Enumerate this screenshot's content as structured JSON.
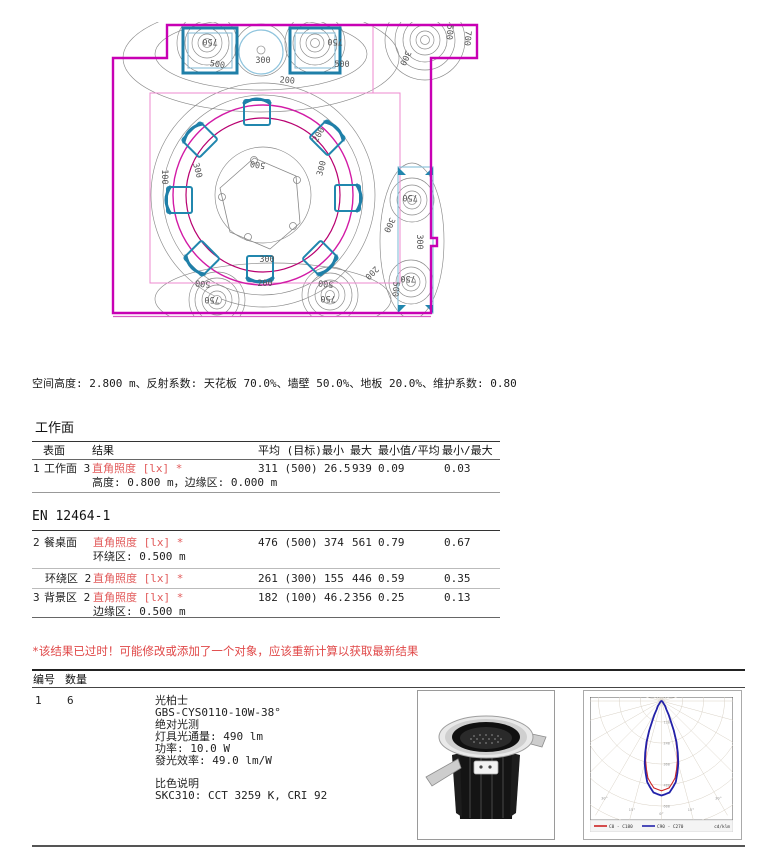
{
  "summary": "空间高度: 2.800 m、反射系数: 天花板 70.0%、墙壁 50.0%、地板 20.0%、维护系数: 0.80",
  "worksurface": {
    "title": "工作面",
    "headers": {
      "surface": "表面",
      "result": "结果",
      "avg": "平均 (目标)",
      "min": "最小",
      "max": "最大",
      "min_avg": "最小值/平均",
      "min_max": "最小/最大"
    },
    "row": {
      "num": "1",
      "surface": "工作面 3",
      "result": "直角照度 [lx] *",
      "sub": "高度: 0.800 m，边缘区: 0.000 m",
      "avg": "311 (500)",
      "min": "26.5",
      "max": "939",
      "min_avg": "0.09",
      "min_max": "0.03"
    }
  },
  "en_standard": {
    "title": "EN 12464-1",
    "row2": {
      "num": "2",
      "surface": "餐桌面",
      "result": "直角照度 [lx] *",
      "sub": "环绕区: 0.500 m",
      "avg": "476 (500)",
      "min": "374",
      "max": "561",
      "min_avg": "0.79",
      "min_max": "0.67"
    },
    "row_surround": {
      "num": "",
      "surface": "环绕区 2",
      "result": "直角照度 [lx] *",
      "avg": "261 (300)",
      "min": "155",
      "max": "446",
      "min_avg": "0.59",
      "min_max": "0.35"
    },
    "row3": {
      "num": "3",
      "surface": "背景区 2",
      "result": "直角照度 [lx] *",
      "sub": "边缘区: 0.500 m",
      "avg": "182 (100)",
      "min": "46.2",
      "max": "356",
      "min_avg": "0.25",
      "min_max": "0.13"
    }
  },
  "warning": "*该结果已过时！可能修改或添加了一个对象，应该重新计算以获取最新结果",
  "luminaires": {
    "header_id": "编号",
    "header_qty": "数量",
    "row": {
      "id": "1",
      "qty": "6",
      "maker": "光柏士",
      "model": "GBS-CYS0110-10W-38°",
      "photometry": "绝对光测",
      "flux": "灯具光通量: 490 lm",
      "power": "功率: 10.0 W",
      "efficacy": "發光效率: 49.0 lm/W",
      "color_title": "比色说明",
      "color_spec": "SKC310: CCT 3259 K, CRI 92"
    }
  },
  "plan": {
    "colors": {
      "wall": "#c800b4",
      "zone_outer": "#d21ba6",
      "zone_inner": "#b80070",
      "calc_rect": "#ec89cf",
      "furniture": "#2187ae",
      "furniture_light": "#8fc4dd",
      "contour": "#8a8a8a"
    },
    "labels": [
      {
        "x": 110,
        "y": 29,
        "text": "750",
        "rot": 180
      },
      {
        "x": 117,
        "y": 57,
        "text": "500",
        "rot": 8
      },
      {
        "x": 163,
        "y": 53,
        "text": "300",
        "rot": 0
      },
      {
        "x": 187,
        "y": 73,
        "text": "200",
        "rot": 5
      },
      {
        "x": 235,
        "y": 29,
        "text": "750",
        "rot": 180
      },
      {
        "x": 242,
        "y": 57,
        "text": "500",
        "rot": 0
      },
      {
        "x": 347,
        "y": 22,
        "text": "500",
        "rot": 95
      },
      {
        "x": 365,
        "y": 28,
        "text": "700",
        "rot": 95
      },
      {
        "x": 303,
        "y": 47,
        "text": "300",
        "rot": 115
      },
      {
        "x": 158,
        "y": 152,
        "text": "500",
        "rot": 188
      },
      {
        "x": 95,
        "y": 161,
        "text": "300",
        "rot": 75
      },
      {
        "x": 224,
        "y": 159,
        "text": "300",
        "rot": -75
      },
      {
        "x": 62,
        "y": 167,
        "text": "100",
        "rot": 90
      },
      {
        "x": 221,
        "y": 126,
        "text": "200",
        "rot": -60
      },
      {
        "x": 167,
        "y": 252,
        "text": "300",
        "rot": 0
      },
      {
        "x": 165,
        "y": 276,
        "text": "200",
        "rot": 0
      },
      {
        "x": 103,
        "y": 271,
        "text": "500",
        "rot": 185
      },
      {
        "x": 112,
        "y": 287,
        "text": "750",
        "rot": 180
      },
      {
        "x": 226,
        "y": 271,
        "text": "500",
        "rot": 185
      },
      {
        "x": 228,
        "y": 286,
        "text": "750",
        "rot": 180
      },
      {
        "x": 270,
        "y": 261,
        "text": "200",
        "rot": 135
      },
      {
        "x": 310,
        "y": 185,
        "text": "750",
        "rot": 180
      },
      {
        "x": 317,
        "y": 232,
        "text": "300",
        "rot": 90
      },
      {
        "x": 287,
        "y": 214,
        "text": "300",
        "rot": 115
      },
      {
        "x": 308,
        "y": 266,
        "text": "750",
        "rot": 180
      },
      {
        "x": 293,
        "y": 279,
        "text": "500",
        "rot": 95
      }
    ]
  },
  "chart_data": {
    "type": "polar_intensity",
    "legend": {
      "c0": "C0 - C180",
      "c90": "C90 - C270"
    },
    "unit": "cd/klm",
    "rings": [
      120,
      240,
      360,
      480,
      600
    ],
    "ring_px": 21,
    "px_per_unit": 0.175,
    "profile": [
      [
        0,
        540
      ],
      [
        5,
        525
      ],
      [
        10,
        470
      ],
      [
        15,
        370
      ],
      [
        20,
        250
      ],
      [
        25,
        120
      ],
      [
        30,
        55
      ],
      [
        40,
        18
      ],
      [
        50,
        8
      ],
      [
        60,
        4
      ],
      [
        75,
        2
      ],
      [
        90,
        0
      ]
    ]
  }
}
